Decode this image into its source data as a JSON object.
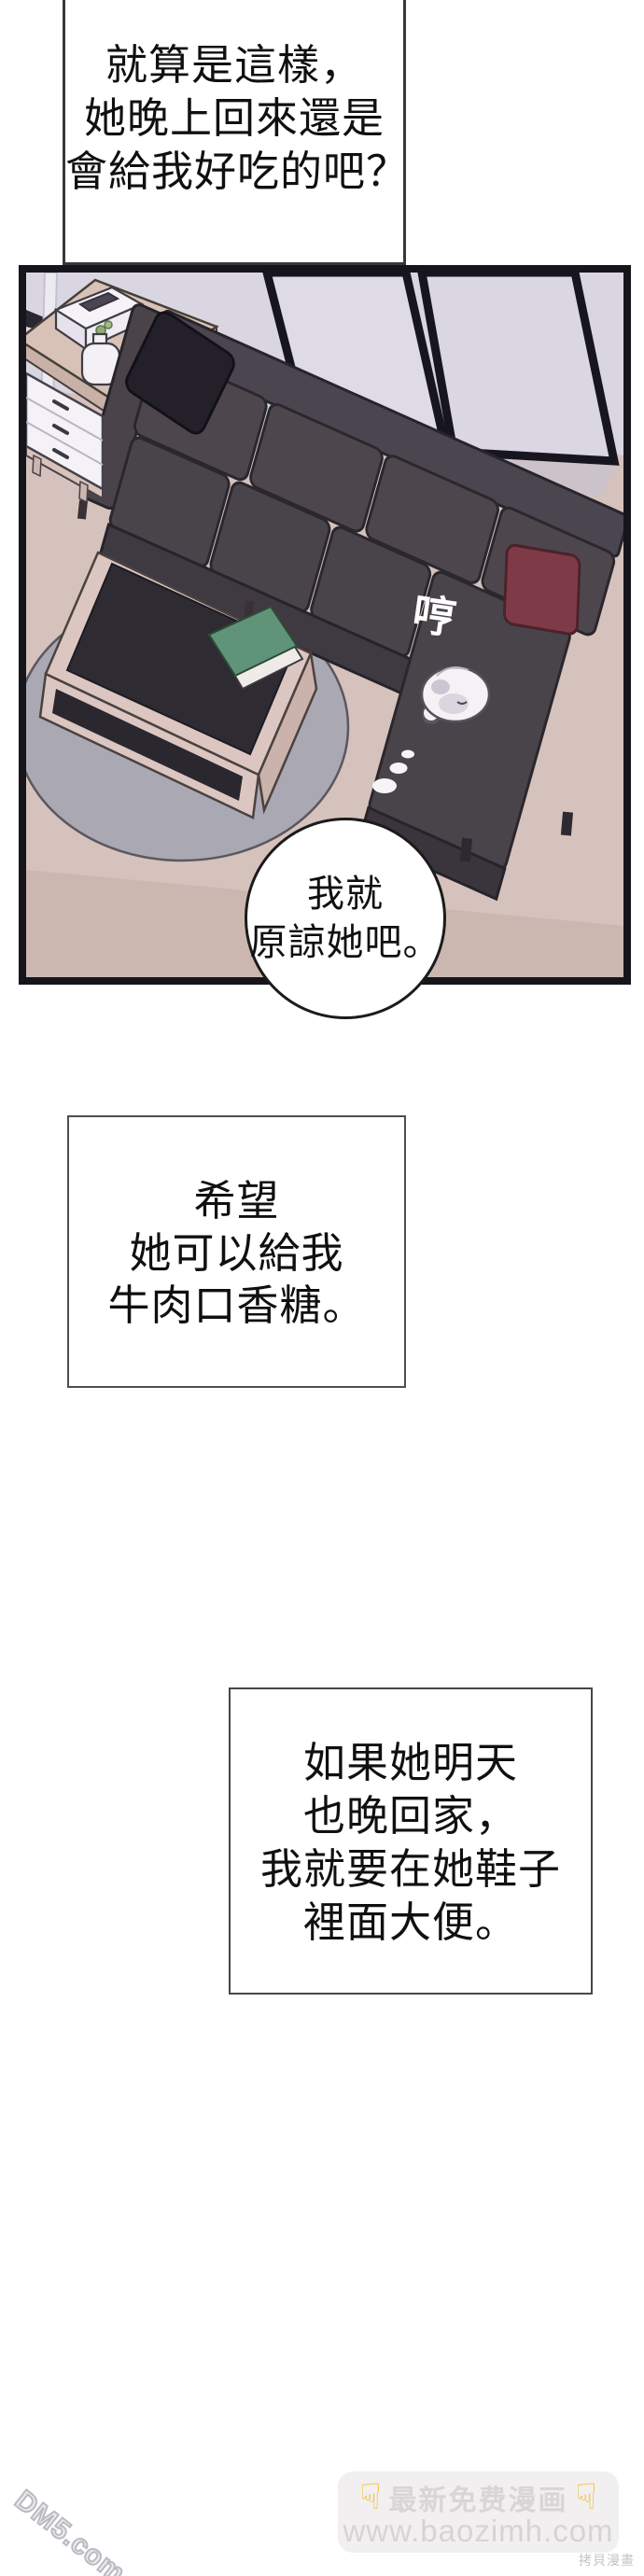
{
  "narration": {
    "top": {
      "lines": [
        "就算是這樣，",
        "她晚上回來還是",
        "會給我好吃的吧？"
      ]
    },
    "middle": {
      "lines": [
        "希望",
        "她可以給我",
        "牛肉口香糖。"
      ]
    },
    "bottom": {
      "lines": [
        "如果她明天",
        "也晚回家，",
        "我就要在她鞋子",
        "裡面大便。"
      ]
    }
  },
  "bubble": {
    "lines": [
      "我就",
      "原諒她吧。"
    ]
  },
  "panel": {
    "sfx": "哼"
  },
  "watermarks": {
    "badge": {
      "hand_icon": "☟",
      "line1": "最新免费漫画",
      "url": "www.baozimh.com"
    },
    "corner": "拷貝漫畫",
    "diagonal": "DM5.com"
  },
  "colors": {
    "page_bg": "#ffffff",
    "panel_border": "#16151c",
    "wall": "#d9d6e1",
    "floor": "#d5c2bd",
    "rug": "#a9a8b3",
    "couch": "#4a444a",
    "black_pillow": "#232029",
    "red_pillow": "#7e3b47",
    "coffee_table": "#dcc6c1",
    "table_top_inset": "#2e2b32",
    "green_book": "#5f9478",
    "dog": "#f4f2f5",
    "sfx_text": "#ffffff",
    "badge_bg": "#f1eff0",
    "badge_text": "#d9d5d7",
    "hand_yellow": "#f2bc33"
  }
}
